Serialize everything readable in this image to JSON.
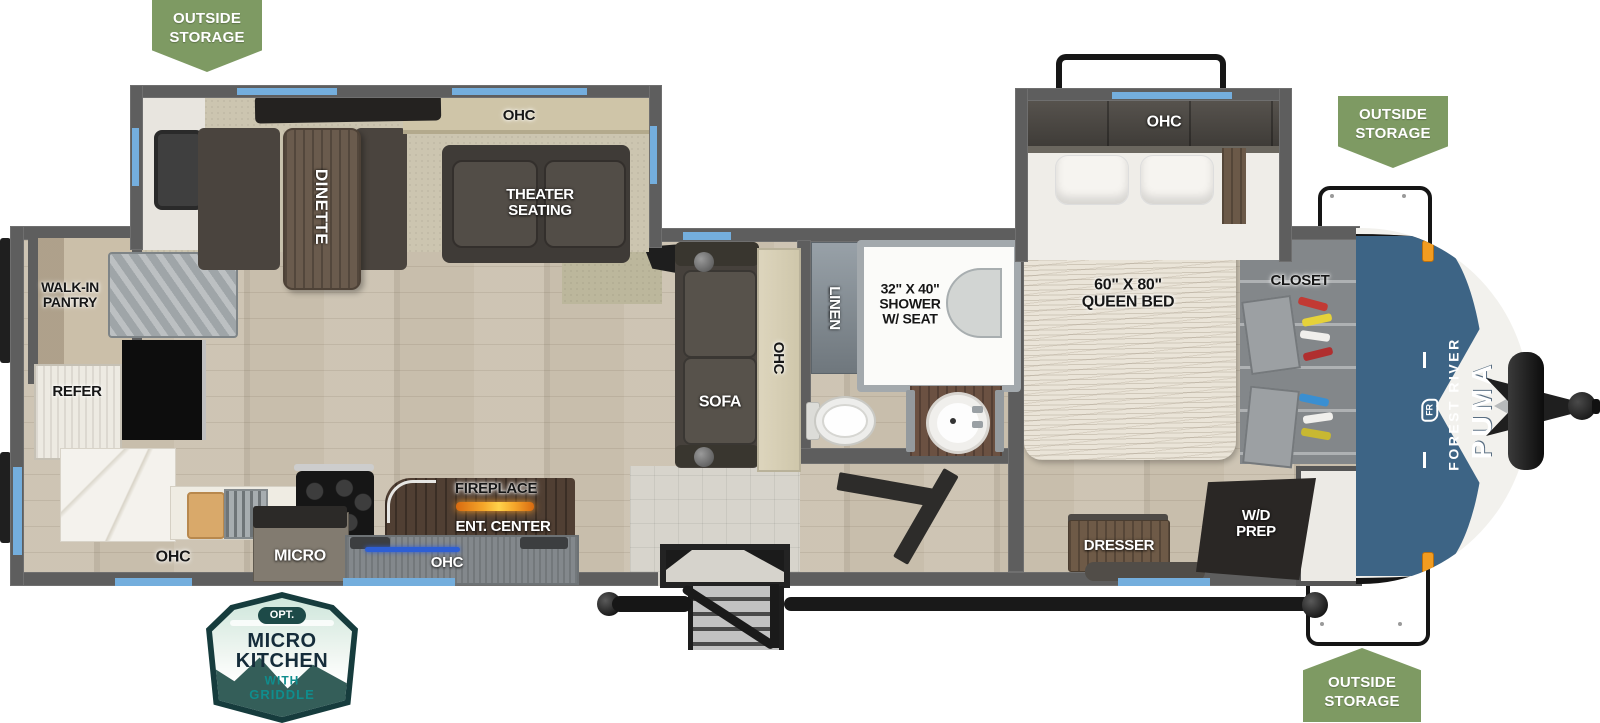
{
  "title": "Forest River Puma travel trailer floor plan",
  "badges": {
    "top_left": "OUTSIDE\nSTORAGE",
    "top_right": "OUTSIDE\nSTORAGE",
    "bottom_right": "OUTSIDE\nSTORAGE",
    "micro_kitchen": {
      "opt": "OPT.",
      "line1": "MICRO",
      "line2": "KITCHEN",
      "line3": "WITH",
      "line4": "GRIDDLE"
    }
  },
  "branding": {
    "make": "FOREST RIVER",
    "model": "PUMA",
    "monogram": "FR"
  },
  "labels": {
    "walk_in_pantry": "WALK-IN\nPANTRY",
    "refer": "REFER",
    "ohc_kitchen": "OHC",
    "micro": "MICRO",
    "fireplace": "FIREPLACE",
    "ent_center": "ENT. CENTER",
    "ohc_ent": "OHC",
    "ohc_dinette": "OHC",
    "dinette": "DINETTE",
    "theater": "THEATER\nSEATING",
    "sofa": "SOFA",
    "ohc_sofa": "OHC",
    "linen": "LINEN",
    "shower": "32\" X 40\"\nSHOWER\nW/ SEAT",
    "ohc_bedroom": "OHC",
    "queen_bed": "60\" X 80\"\nQUEEN BED",
    "closet": "CLOSET",
    "dresser": "DRESSER",
    "wd_prep": "W/D\nPREP"
  },
  "colors": {
    "badge_green": "#7e9a63",
    "window_blue": "#74aedd",
    "wall_gray": "#5e5e5e",
    "cap_blue": "#3d6485",
    "flame_orange": "#f59a26",
    "led_blue": "#2e5fd4"
  }
}
